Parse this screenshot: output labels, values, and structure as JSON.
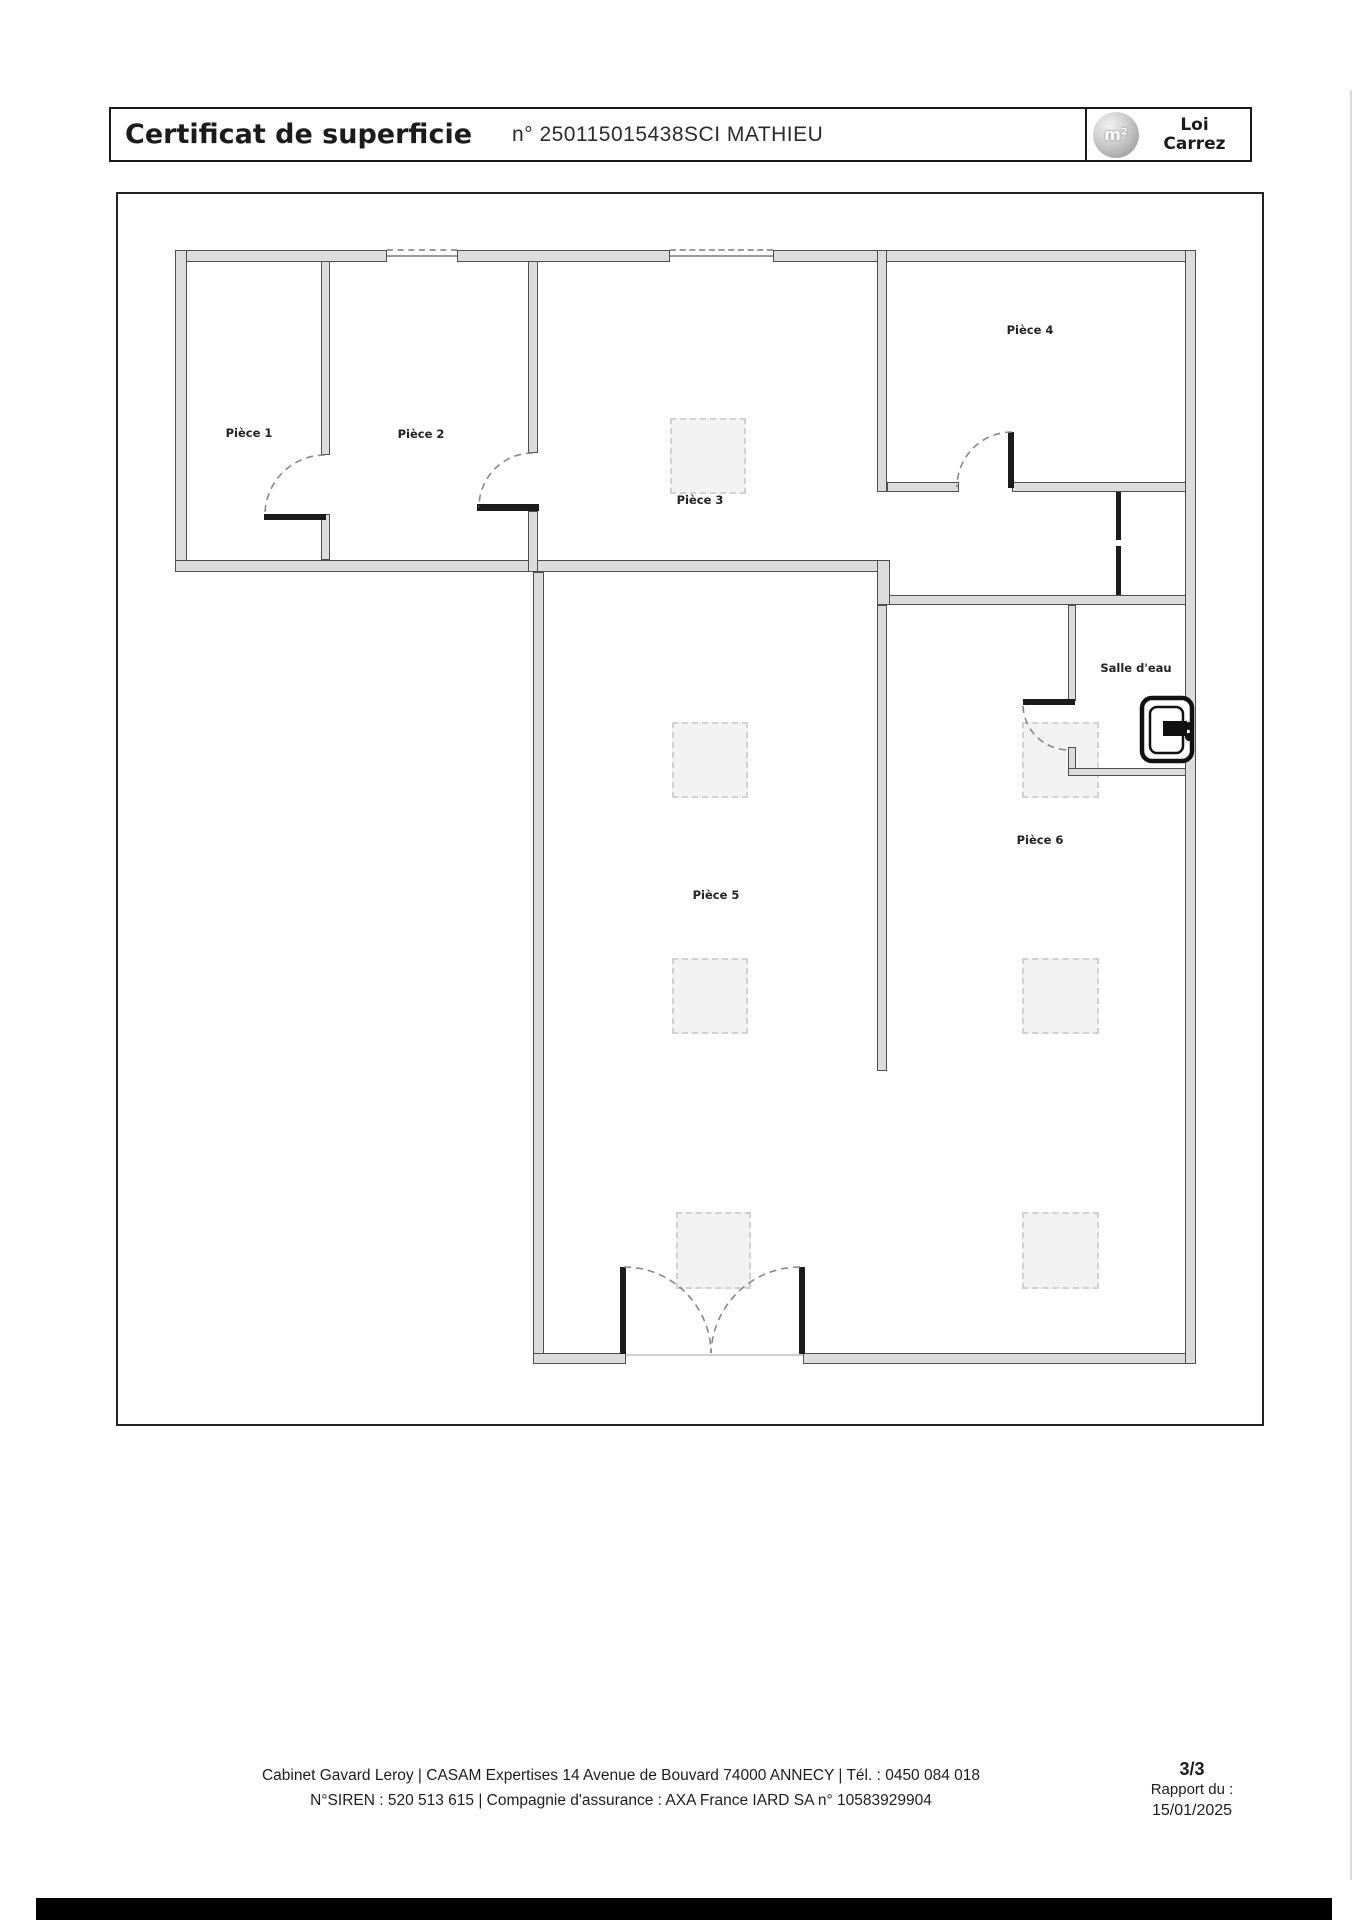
{
  "header": {
    "title": "Certificat de superficie",
    "doc_number": "n° 250115015438SCI MATHIEU",
    "badge": {
      "symbol": "m²",
      "line1": "Loi",
      "line2": "Carrez"
    }
  },
  "plan": {
    "rooms": [
      {
        "id": "piece-1",
        "label": "Pièce 1"
      },
      {
        "id": "piece-2",
        "label": "Pièce 2"
      },
      {
        "id": "piece-3",
        "label": "Pièce 3"
      },
      {
        "id": "piece-4",
        "label": "Pièce 4"
      },
      {
        "id": "piece-5",
        "label": "Pièce 5"
      },
      {
        "id": "piece-6",
        "label": "Pièce 6"
      },
      {
        "id": "salle-d-eau",
        "label": "Salle d'eau"
      }
    ]
  },
  "footer": {
    "line1": "Cabinet Gavard Leroy | CASAM Expertises 14 Avenue de Bouvard 74000 ANNECY | Tél. : 0450 084 018",
    "line2": "N°SIREN : 520 513 615 | Compagnie d'assurance : AXA France IARD SA n° 10583929904",
    "page": "3/3",
    "report_label": "Rapport du :",
    "report_date": "15/01/2025"
  },
  "colors": {
    "wall_fill": "#dcdcdc",
    "wall_edge": "#4f4f4f",
    "arc": "#888888",
    "column_fill": "#f2f2f2",
    "bar": "#000000"
  }
}
